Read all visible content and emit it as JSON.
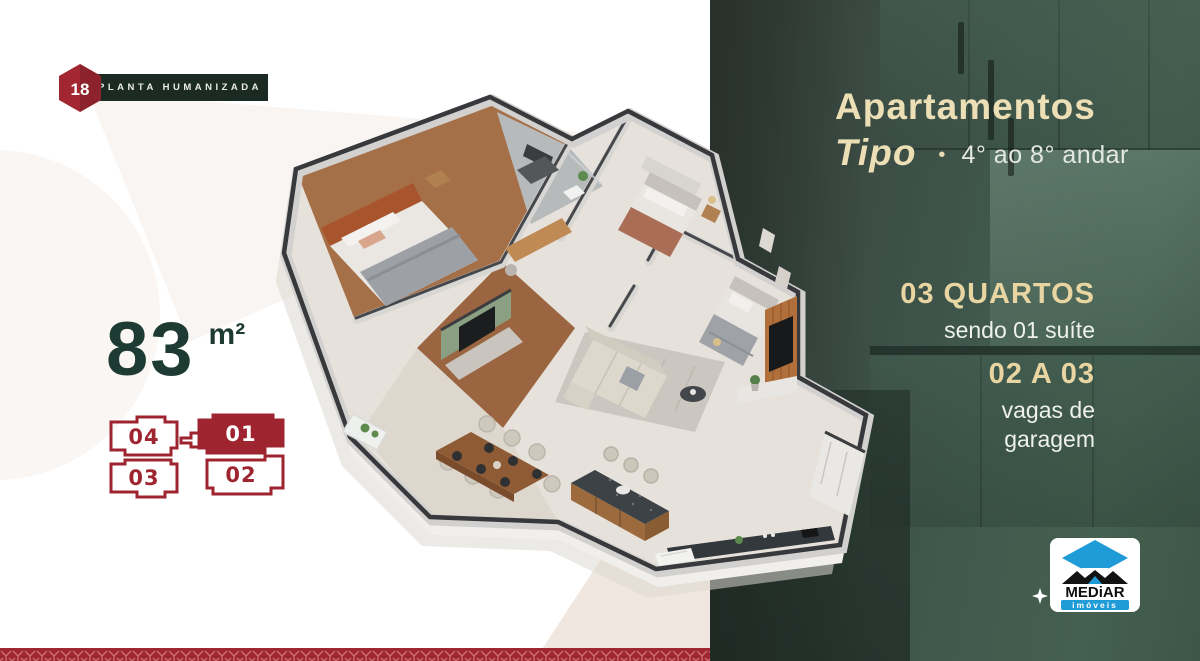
{
  "badge": {
    "number": "18",
    "label": "PLANTA HUMANIZADA"
  },
  "area": {
    "value": "83",
    "unit": "m²"
  },
  "unit_map": {
    "units": [
      {
        "id": "04",
        "active": false
      },
      {
        "id": "01",
        "active": true
      },
      {
        "id": "03",
        "active": false
      },
      {
        "id": "02",
        "active": false
      }
    ]
  },
  "panel": {
    "title_line1": "Apartamentos",
    "title_line2": "Tipo",
    "separator": "•",
    "subtitle": "4° ao 8° andar",
    "features": [
      {
        "headline": "03 QUARTOS",
        "detail": "sendo 01 suíte"
      },
      {
        "headline": "02 A 03",
        "detail": "vagas de garagem"
      }
    ]
  },
  "logo": {
    "brand": "MEDiAR",
    "tagline": "imóveis"
  },
  "colors": {
    "brand_red": "#9e2430",
    "strip_red": "#9f2733",
    "dark_green_bar": "#1c2a24",
    "panel_green": "#3d564b",
    "cream": "#e8d5a2",
    "title_green": "#1e3b33",
    "logo_blue": "#1f9bd7"
  }
}
